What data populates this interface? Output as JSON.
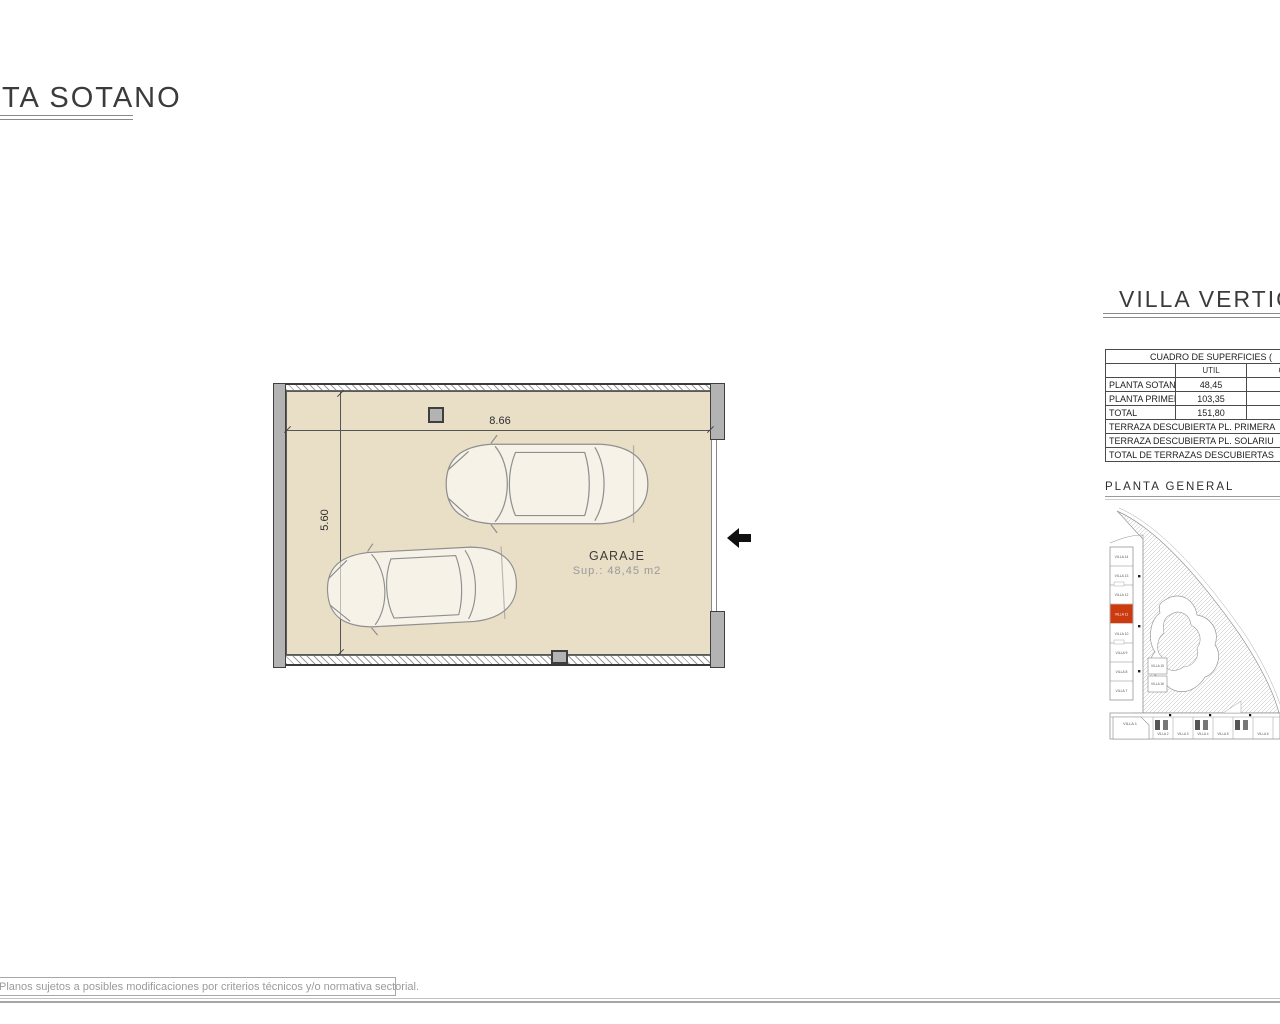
{
  "page": {
    "title_left": "TA SOTANO",
    "title_right": "VILLA VERTICA",
    "disclaimer": "Planos sujetos a posibles modificaciones por criterios técnicos y/o normativa sectorial."
  },
  "floor_plan": {
    "room_label": "GARAJE",
    "room_area": "Sup.: 48,45 m2",
    "dim_width": "8.66",
    "dim_height": "5.60"
  },
  "surfaces_table": {
    "title": "CUADRO DE SUPERFICIES (",
    "col_header_util": "UTIL",
    "col_header_cut": "C",
    "rows": [
      {
        "label": "PLANTA SOTANO",
        "util": "48,45"
      },
      {
        "label": "PLANTA PRIMERA",
        "util": "103,35"
      },
      {
        "label": "TOTAL",
        "util": "151,80"
      }
    ]
  },
  "terraces_table": {
    "rows": [
      {
        "label": "TERRAZA DESCUBIERTA PL. PRIMERA"
      },
      {
        "label": "TERRAZA DESCUBIERTA PL. SOLARIU"
      },
      {
        "label": "TOTAL DE TERRAZAS DESCUBIERTAS"
      }
    ]
  },
  "site_plan": {
    "title": "PLANTA  GENERAL",
    "highlight_color": "#cc3a10",
    "left_villas": [
      {
        "label": "VILLA 14"
      },
      {
        "label": "VILLA 13"
      },
      {
        "label": "VILLA 12"
      },
      {
        "label": "VILLA 11"
      },
      {
        "label": "VILLA 10"
      },
      {
        "label": "VILLA 9"
      },
      {
        "label": "VILLA 8"
      },
      {
        "label": "VILLA 7"
      }
    ],
    "inner_villas": [
      {
        "label": "VILLA 15"
      },
      {
        "label": "VILLA 16"
      }
    ],
    "bottom_villas": [
      {
        "label": "VILLA 1"
      },
      {
        "label": "VILLA 2"
      },
      {
        "label": "VILLA 3"
      },
      {
        "label": "VILLA 4"
      },
      {
        "label": "VILLA 5"
      },
      {
        "label": "VILLA 6"
      }
    ]
  }
}
